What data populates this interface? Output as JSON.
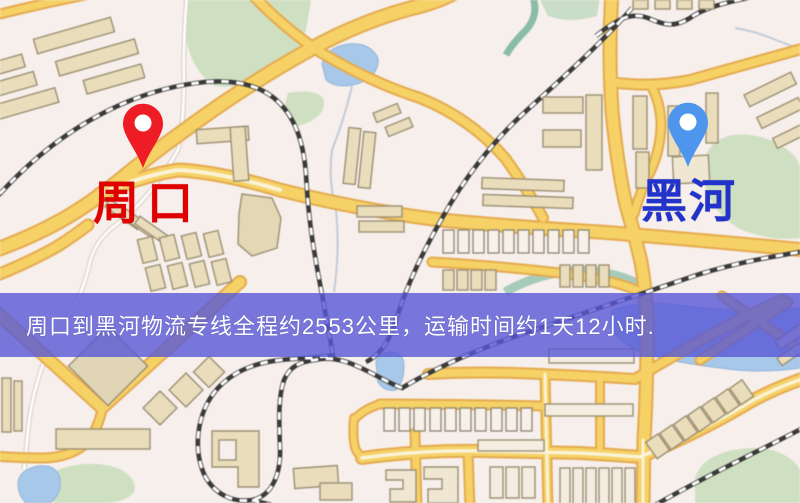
{
  "window": {
    "width": 800,
    "height": 503
  },
  "map": {
    "kind": "street-map",
    "origin_marker": {
      "id": "zhoukou",
      "label": "周口",
      "pin_color": "#ee1c24",
      "label_color": "#e00000"
    },
    "destination_marker": {
      "id": "heihe",
      "label": "黑河",
      "pin_color": "#4e95ee",
      "label_color": "#2233cc"
    },
    "banner": {
      "text": "周口到黑河物流专线全程约2553公里，运输时间约1天12小时.",
      "bg_color": "#5858d6",
      "text_color": "#ffffff"
    },
    "route": {
      "from": "周口",
      "to": "黑河",
      "distance_km": "2553",
      "duration": "1天12小时"
    },
    "colors": {
      "background": "#f7efeb",
      "road_fill": "#f4d169",
      "road_casing": "#e3aa52",
      "water": "#a9c8e8",
      "park": "#cfe0c3",
      "railway": "#3a3a3a",
      "building": "#e9ddbd"
    }
  }
}
